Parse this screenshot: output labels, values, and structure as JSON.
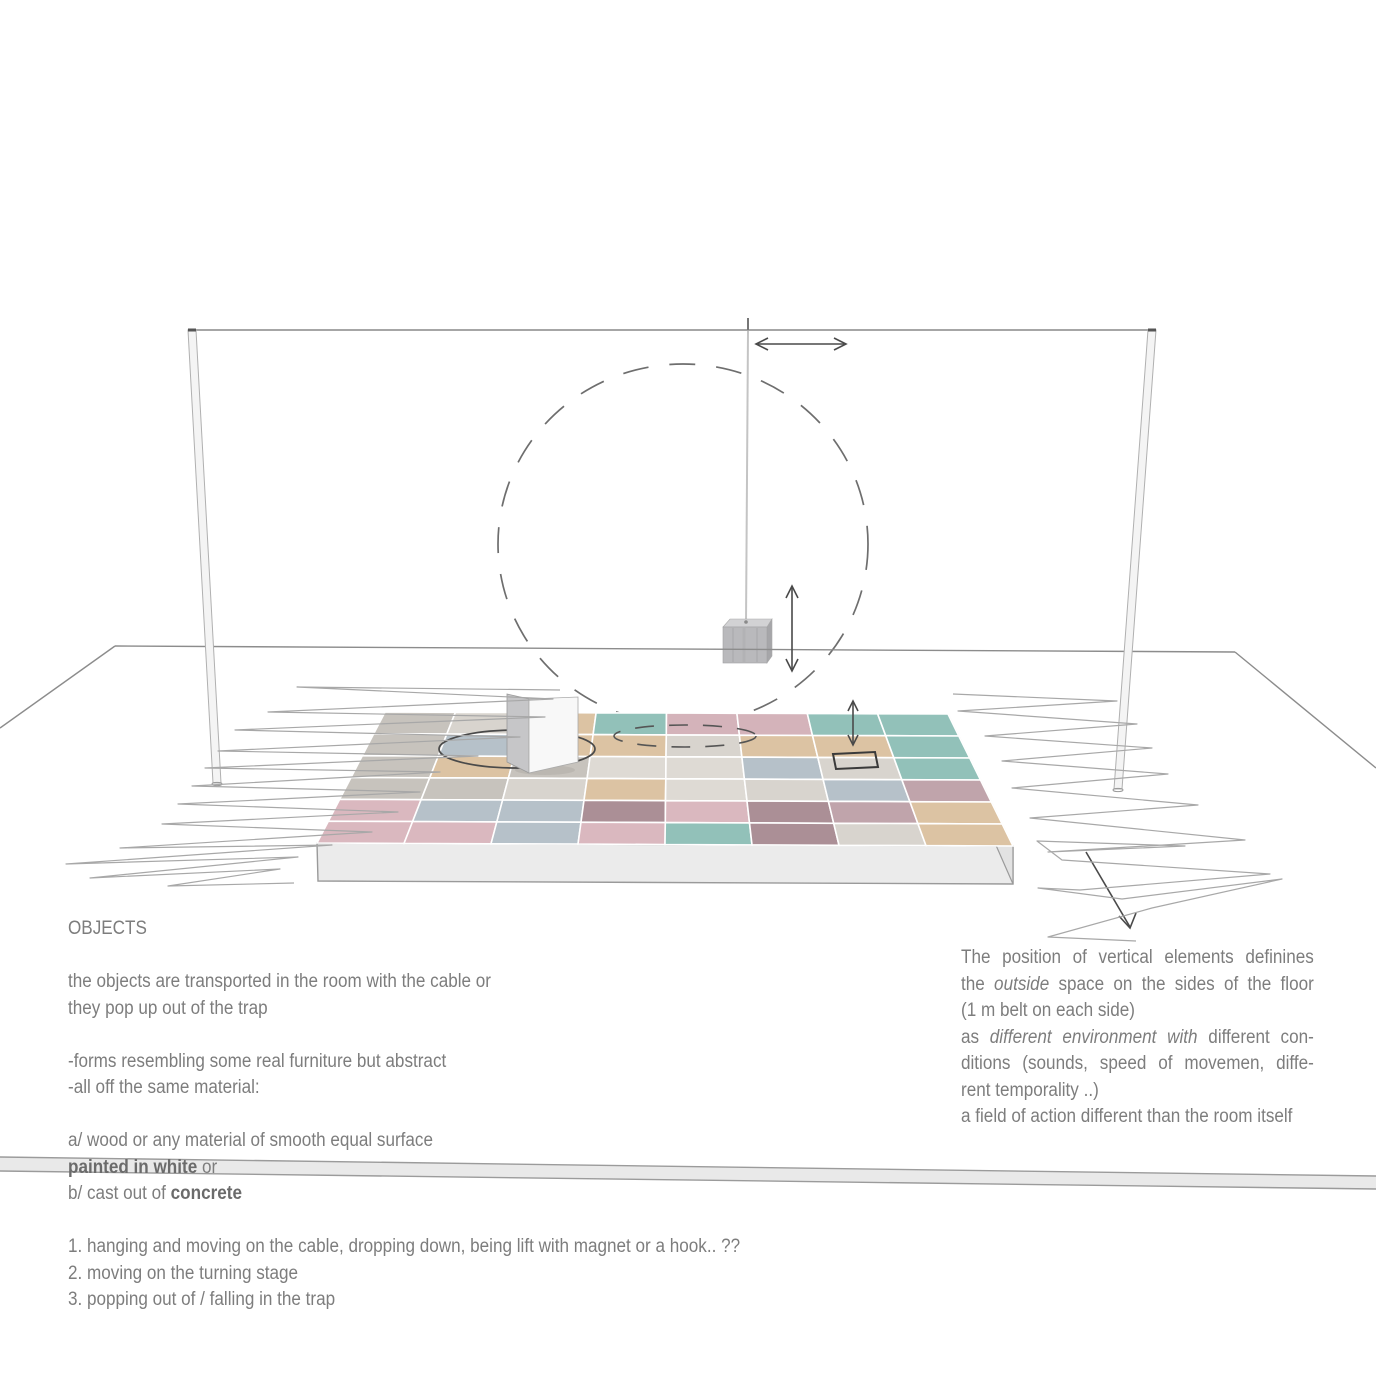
{
  "page": {
    "background": "#ffffff",
    "kind": "stage concept diagram page"
  },
  "diagram": {
    "colors": {
      "line_gray": "#8c8c8c",
      "sketch_gray": "#a8a8a8",
      "arrow_gray": "#4a4a4a",
      "dash_gray": "#6e6e6e",
      "pole_fill": "#f4f4f4",
      "pole_stroke": "#b0b0b0",
      "cable": "#9a9a9a",
      "hang_cable": "#c4c4c4",
      "band_fill": "#e9e9e9",
      "band_stroke": "#9b9b9b",
      "skirt_front": "#ebebeb",
      "skirt_side": "#e2e2e2",
      "cube_front": "#b9b9bc",
      "cube_top": "#d2d2d4",
      "cube_side": "#a6a6a9",
      "panel_left": "#c6c6c8",
      "panel_right": "#f8f8f8",
      "trap_stroke": "#3a3a3a",
      "stage_ellipse": "#4a4a4a"
    },
    "tile_palette": {
      "g": "#c7c3bd",
      "l": "#d8d4ce",
      "t": "#dcc3a3",
      "e": "#92c1b9",
      "r": "#d4b3ba",
      "d": "#dab8bf",
      "b": "#b6c1c9",
      "w": "#dedad4",
      "m": "#c0a4ab",
      "k": "#ab8f96"
    },
    "tile_matrix": [
      [
        "g",
        "l",
        "t",
        "e",
        "r",
        "r",
        "e",
        "e"
      ],
      [
        "g",
        "b",
        "t",
        "t",
        "l",
        "t",
        "t",
        "e"
      ],
      [
        "g",
        "t",
        "g",
        "w",
        "w",
        "b",
        "l",
        "e"
      ],
      [
        "g",
        "g",
        "l",
        "t",
        "w",
        "l",
        "b",
        "m"
      ],
      [
        "d",
        "b",
        "b",
        "k",
        "d",
        "k",
        "m",
        "t"
      ],
      [
        "d",
        "d",
        "b",
        "d",
        "e",
        "k",
        "l",
        "t"
      ]
    ]
  },
  "text": {
    "left_block": {
      "lines": [
        {
          "segments": [
            {
              "t": "OBJECTS"
            }
          ]
        },
        {
          "segments": []
        },
        {
          "segments": [
            {
              "t": "the objects are transported in the room with the cable or"
            }
          ]
        },
        {
          "segments": [
            {
              "t": "they pop up out of the trap"
            }
          ]
        },
        {
          "segments": []
        },
        {
          "segments": [
            {
              "t": "-forms resembling some real furniture but abstract"
            }
          ]
        },
        {
          "segments": [
            {
              "t": "-all off the same material:"
            }
          ]
        },
        {
          "segments": []
        },
        {
          "segments": [
            {
              "t": "a/ wood or any material of smooth equal surface"
            }
          ]
        },
        {
          "segments": [
            {
              "t": "painted in white",
              "b": true
            },
            {
              "t": " or"
            }
          ]
        },
        {
          "segments": [
            {
              "t": "b/ cast out of "
            },
            {
              "t": "concrete",
              "b": true
            }
          ]
        },
        {
          "segments": []
        },
        {
          "segments": [
            {
              "t": "1. hanging and moving on the cable, dropping down, being lift with magnet or a hook.. ??"
            }
          ]
        },
        {
          "segments": [
            {
              "t": "2. moving on the turning stage"
            }
          ]
        },
        {
          "segments": [
            {
              "t": "3. popping out of / falling in the trap"
            }
          ]
        }
      ]
    },
    "right_block": {
      "lines": [
        {
          "justify": true,
          "segments": [
            {
              "t": "The position of vertical elements definines"
            }
          ]
        },
        {
          "justify": true,
          "segments": [
            {
              "t": "the "
            },
            {
              "t": "outside",
              "i": true
            },
            {
              "t": " space on the sides of the floor"
            }
          ]
        },
        {
          "justify": false,
          "segments": [
            {
              "t": "(1 m belt on each side)"
            }
          ]
        },
        {
          "justify": true,
          "segments": [
            {
              "t": "as "
            },
            {
              "t": "different environment with",
              "i": true
            },
            {
              "t": " different con-"
            }
          ]
        },
        {
          "justify": true,
          "segments": [
            {
              "t": "ditions (sounds, speed of movemen, diffe-"
            }
          ]
        },
        {
          "justify": false,
          "segments": [
            {
              "t": "rent temporality ..)"
            }
          ]
        },
        {
          "justify": false,
          "segments": [
            {
              "t": "a field of action different than the room itself"
            }
          ]
        }
      ]
    }
  }
}
